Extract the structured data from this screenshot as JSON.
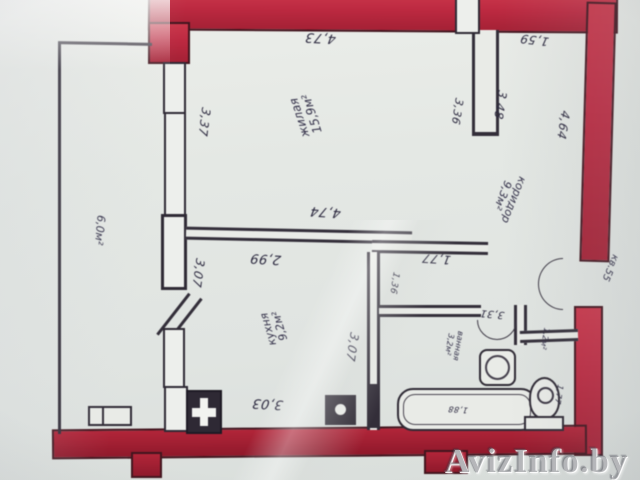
{
  "photo": {
    "watermark": "AvizInfo.by"
  },
  "floor_plan": {
    "apartment_label": "кв.55",
    "rooms": {
      "living": {
        "label": "жилая",
        "area": "15,9м²"
      },
      "corridor": {
        "label": "коридор",
        "area": "9,3м²"
      },
      "kitchen": {
        "label": "кухня",
        "area": "9,2м²"
      },
      "balcony": {
        "area": "6,0м²"
      },
      "bathroom": {
        "label": "ванная",
        "area": "3,2м²"
      },
      "wc": {
        "area": "1,2м²"
      }
    },
    "dimensions": {
      "living_top_width": "4,73",
      "closet_top_width": "1,59",
      "living_left_height": "3,37",
      "living_right_height": "3,36",
      "closet_side_height": "3,48",
      "corridor_right_height": "4,64",
      "living_bottom_width": "4,74",
      "kitchen_top_width": "2,99",
      "hall_top_width": "1,77",
      "kitchen_left_height": "3,07",
      "bath_door_width": "1,36",
      "kitchen_right_height": "3,07",
      "bathroom_top_width": "3,31",
      "kitchen_bottom_width": "3,03",
      "bathtub_length": "1,88",
      "wc_side_height": "1,77"
    },
    "colors": {
      "wall_red": "#c22740",
      "ink_line": "#332e3a",
      "paper": "#e4e8e4"
    }
  }
}
